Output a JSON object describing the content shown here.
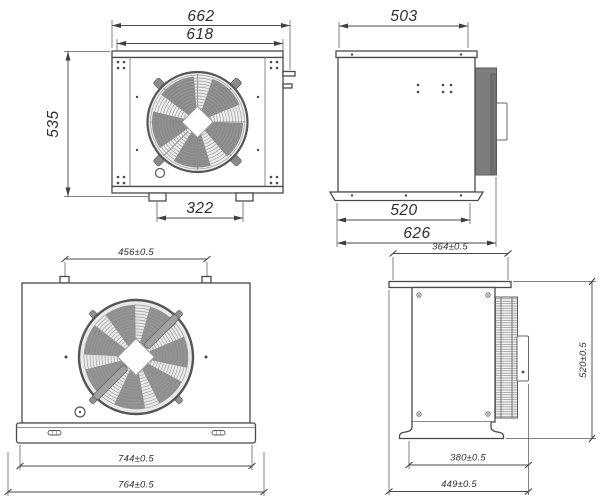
{
  "drawing": {
    "type": "engineering-drawing",
    "subject": "condensing unit with axial fan, four orthographic views with dimensions"
  },
  "views": {
    "top_front": {
      "outer_width": "662",
      "inner_width": "618",
      "height": "535",
      "feet_spacing": "322"
    },
    "top_side": {
      "top_width": "503",
      "base_width": "520",
      "overall_depth": "626"
    },
    "bottom_front": {
      "mount_spacing": "456±0.5",
      "flange_width": "744±0.5",
      "overall_width": "764±0.5"
    },
    "bottom_side": {
      "top_depth": "364±0.5",
      "height": "520±0.5",
      "base_depth": "380±0.5",
      "overall_depth": "449±0.5"
    }
  },
  "colors": {
    "background": "#ffffff",
    "line": "#4a4a4a",
    "coil_fill": "#7d7d7d",
    "fan_blade": "#8a8a8a",
    "fan_ring": "#e9e9e9"
  }
}
